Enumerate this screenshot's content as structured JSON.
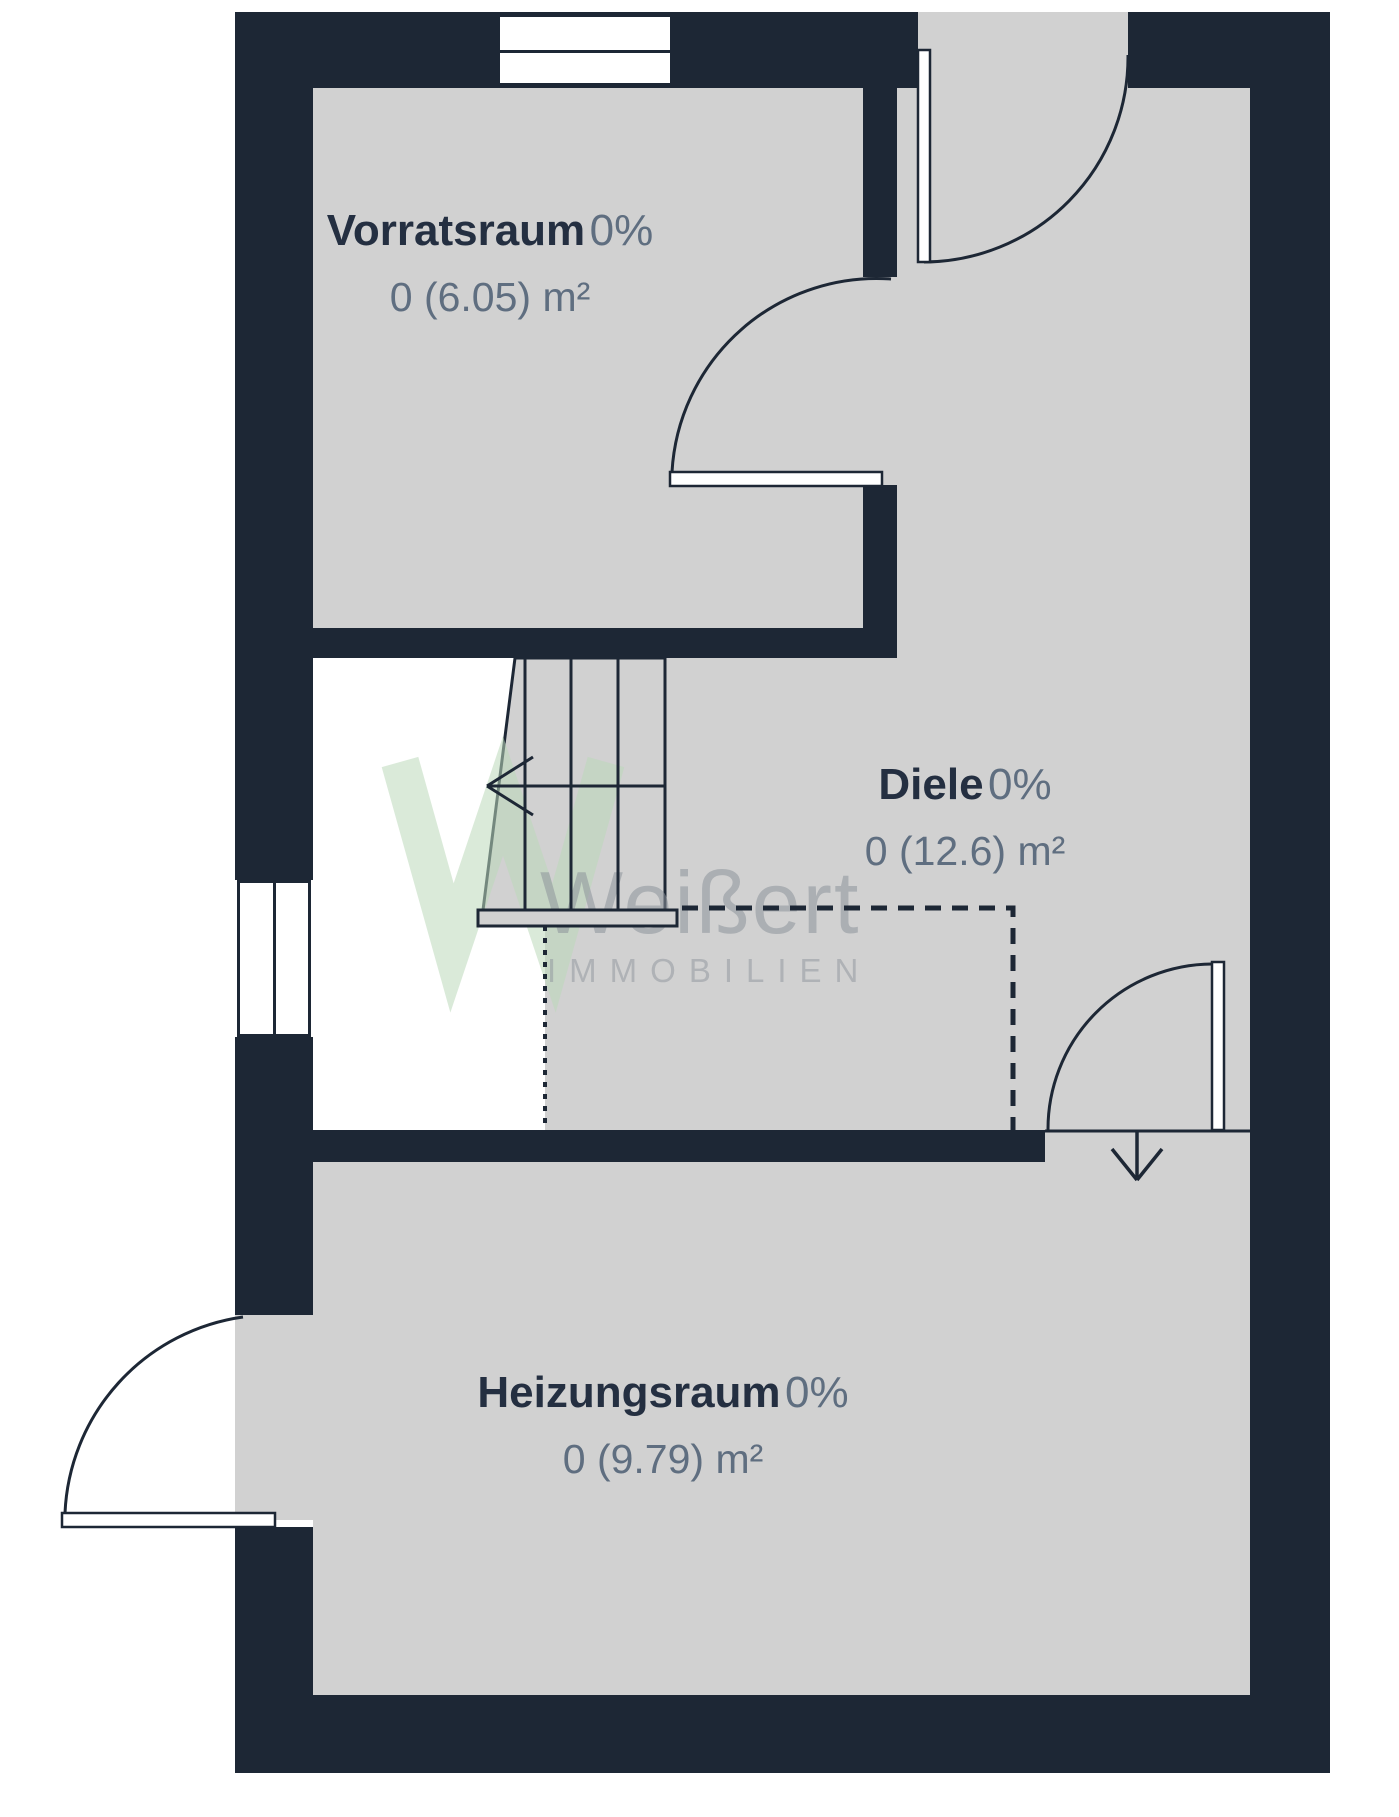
{
  "colors": {
    "wall": "#1d2735",
    "floor": "#d1d1d1",
    "void": "#ffffff",
    "label_primary": "#242f41",
    "label_secondary": "#5f6e80",
    "watermark_green": "#bcd8ba",
    "watermark_gray": "#8d929b"
  },
  "rooms": [
    {
      "name": "Vorratsraum",
      "occupancy": "0%",
      "area": "0 (6.05) m²"
    },
    {
      "name": "Diele",
      "occupancy": "0%",
      "area": "0 (12.6) m²"
    },
    {
      "name": "Heizungsraum",
      "occupancy": "0%",
      "area": "0 (9.79) m²"
    }
  ],
  "watermark": {
    "brand": "Weißert",
    "tagline": "IMMOBILIEN"
  },
  "icons": {
    "stairs_direction_arrow": "left-arrow",
    "entrance_direction_arrow": "down-arrow"
  }
}
